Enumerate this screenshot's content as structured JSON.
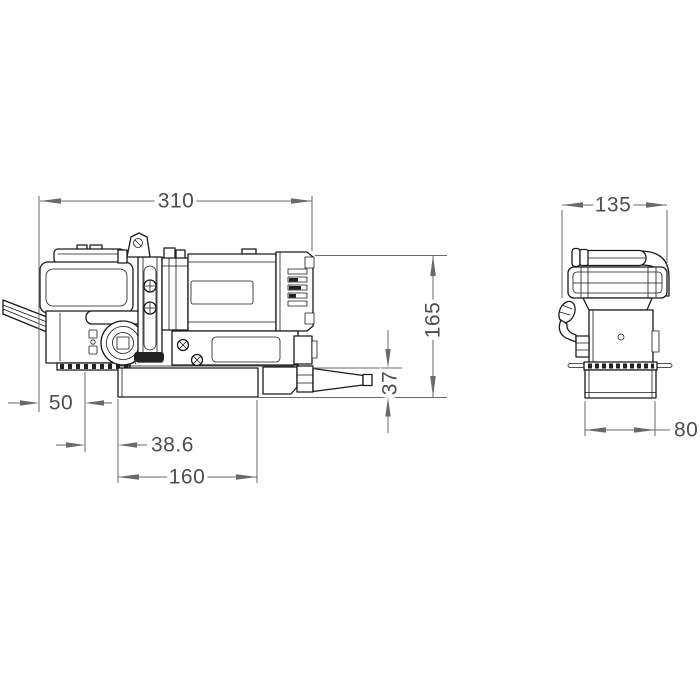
{
  "drawing": {
    "kind": "two-view dimensional engineering drawing",
    "subject": "magnetic-base-drill",
    "line_color": "#1a1a1a",
    "dimension_color": "#6a6a6a",
    "text_color": "#4d4d4d",
    "background": "#ffffff"
  },
  "dimensions": {
    "front": {
      "overall_length": "310",
      "height": "165",
      "spindle_height": "37",
      "left_overhang": "50",
      "spindle_offset": "38.6",
      "base_length": "160"
    },
    "side": {
      "overall_width": "135",
      "base_width": "80"
    }
  }
}
